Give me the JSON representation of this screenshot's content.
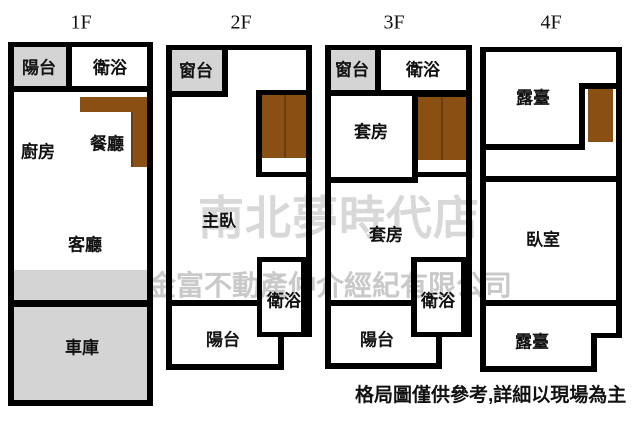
{
  "page": {
    "bottom_note": "格局圖僅供參考,詳細以現場為主"
  },
  "watermarks": {
    "store_line": "南北夢時代店",
    "company_line": "金富不動產仲介經紀有限公司"
  },
  "colors": {
    "wall": "#000000",
    "room_fill_gray": "#d4d4d4",
    "cabinet_brown": "#8a5013",
    "cabinet_divider": "#6b3c0d",
    "watermark_light": "#d8d8d8",
    "watermark_mid": "#c9c9c9",
    "text": "#111111"
  },
  "floors": [
    {
      "title": "1F",
      "rooms": [
        {
          "label": "陽台"
        },
        {
          "label": "衛浴"
        },
        {
          "label": "廚房"
        },
        {
          "label": "餐廳"
        },
        {
          "label": "客廳"
        },
        {
          "label": "車庫"
        }
      ]
    },
    {
      "title": "2F",
      "rooms": [
        {
          "label": "窗台"
        },
        {
          "label": "主臥"
        },
        {
          "label": "衛浴"
        },
        {
          "label": "陽台"
        }
      ]
    },
    {
      "title": "3F",
      "rooms": [
        {
          "label": "窗台"
        },
        {
          "label": "衛浴"
        },
        {
          "label": "套房"
        },
        {
          "label": "套房"
        },
        {
          "label": "衛浴"
        },
        {
          "label": "陽台"
        }
      ]
    },
    {
      "title": "4F",
      "rooms": [
        {
          "label": "露臺"
        },
        {
          "label": "臥室"
        },
        {
          "label": "露臺"
        }
      ]
    }
  ]
}
